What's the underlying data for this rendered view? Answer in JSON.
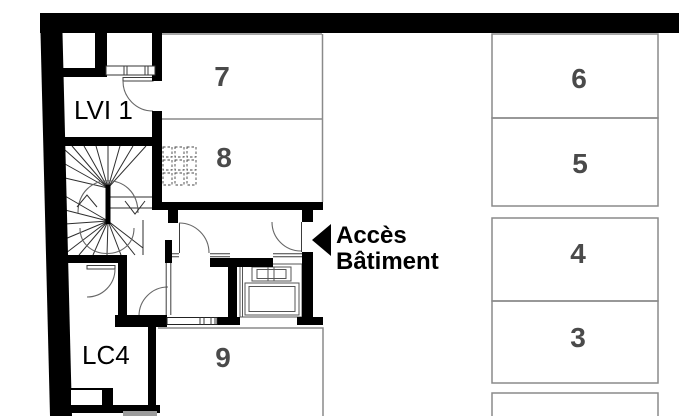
{
  "plan": {
    "unit_labels": {
      "lvi1": "LVI 1",
      "lc4": "LC4"
    },
    "space_numbers": {
      "n3": "3",
      "n4": "4",
      "n5": "5",
      "n6": "6",
      "n7": "7",
      "n8": "8",
      "n9": "9"
    },
    "access": {
      "line1": "Accès",
      "line2": "Bâtiment"
    },
    "colors": {
      "wall": "#000000",
      "box_outline": "#8a8a8a",
      "space_number": "#4a4a4a",
      "label_text": "#000000",
      "ramp_gray": "#9c9c9c",
      "background": "#ffffff"
    }
  }
}
